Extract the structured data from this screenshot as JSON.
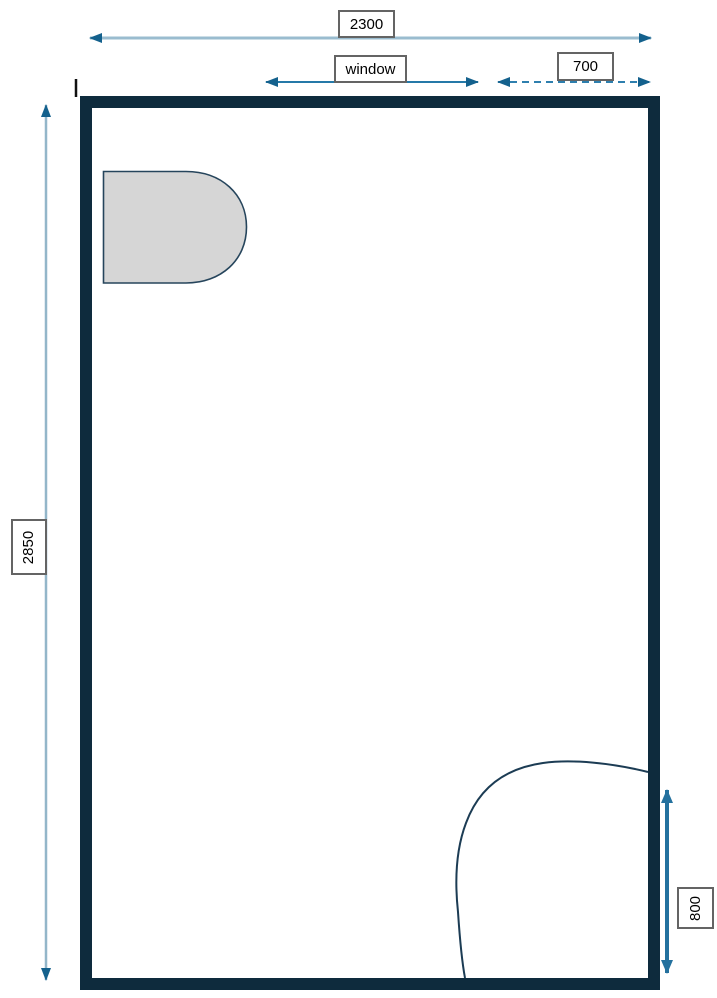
{
  "diagram": {
    "type": "floor-plan",
    "background": "#ffffff",
    "dimensions": {
      "room_width": "2300",
      "room_height": "2850",
      "window_label": "window",
      "window_offset": "700",
      "door_clearance": "800"
    },
    "colors": {
      "wall": "#0e2b3d",
      "dim_line_light": "#9abccf",
      "dim_line_light_v": "#93b6c9",
      "dim_line_mid": "#2579a8",
      "dim_line_dashed": "#2e7fae",
      "dim_line_800": "#24719e",
      "arrowhead_dark": "#14618d",
      "door_arc": "#1c3c54",
      "fixture_fill": "#d6d6d6",
      "fixture_stroke": "#26455c",
      "label_border": "#646464",
      "label_text": "#000000",
      "tick": "#111111"
    },
    "fixtures": [
      {
        "name": "toilet-fixture"
      },
      {
        "name": "door-swing-arc"
      },
      {
        "name": "wall-tick-mark"
      }
    ]
  }
}
